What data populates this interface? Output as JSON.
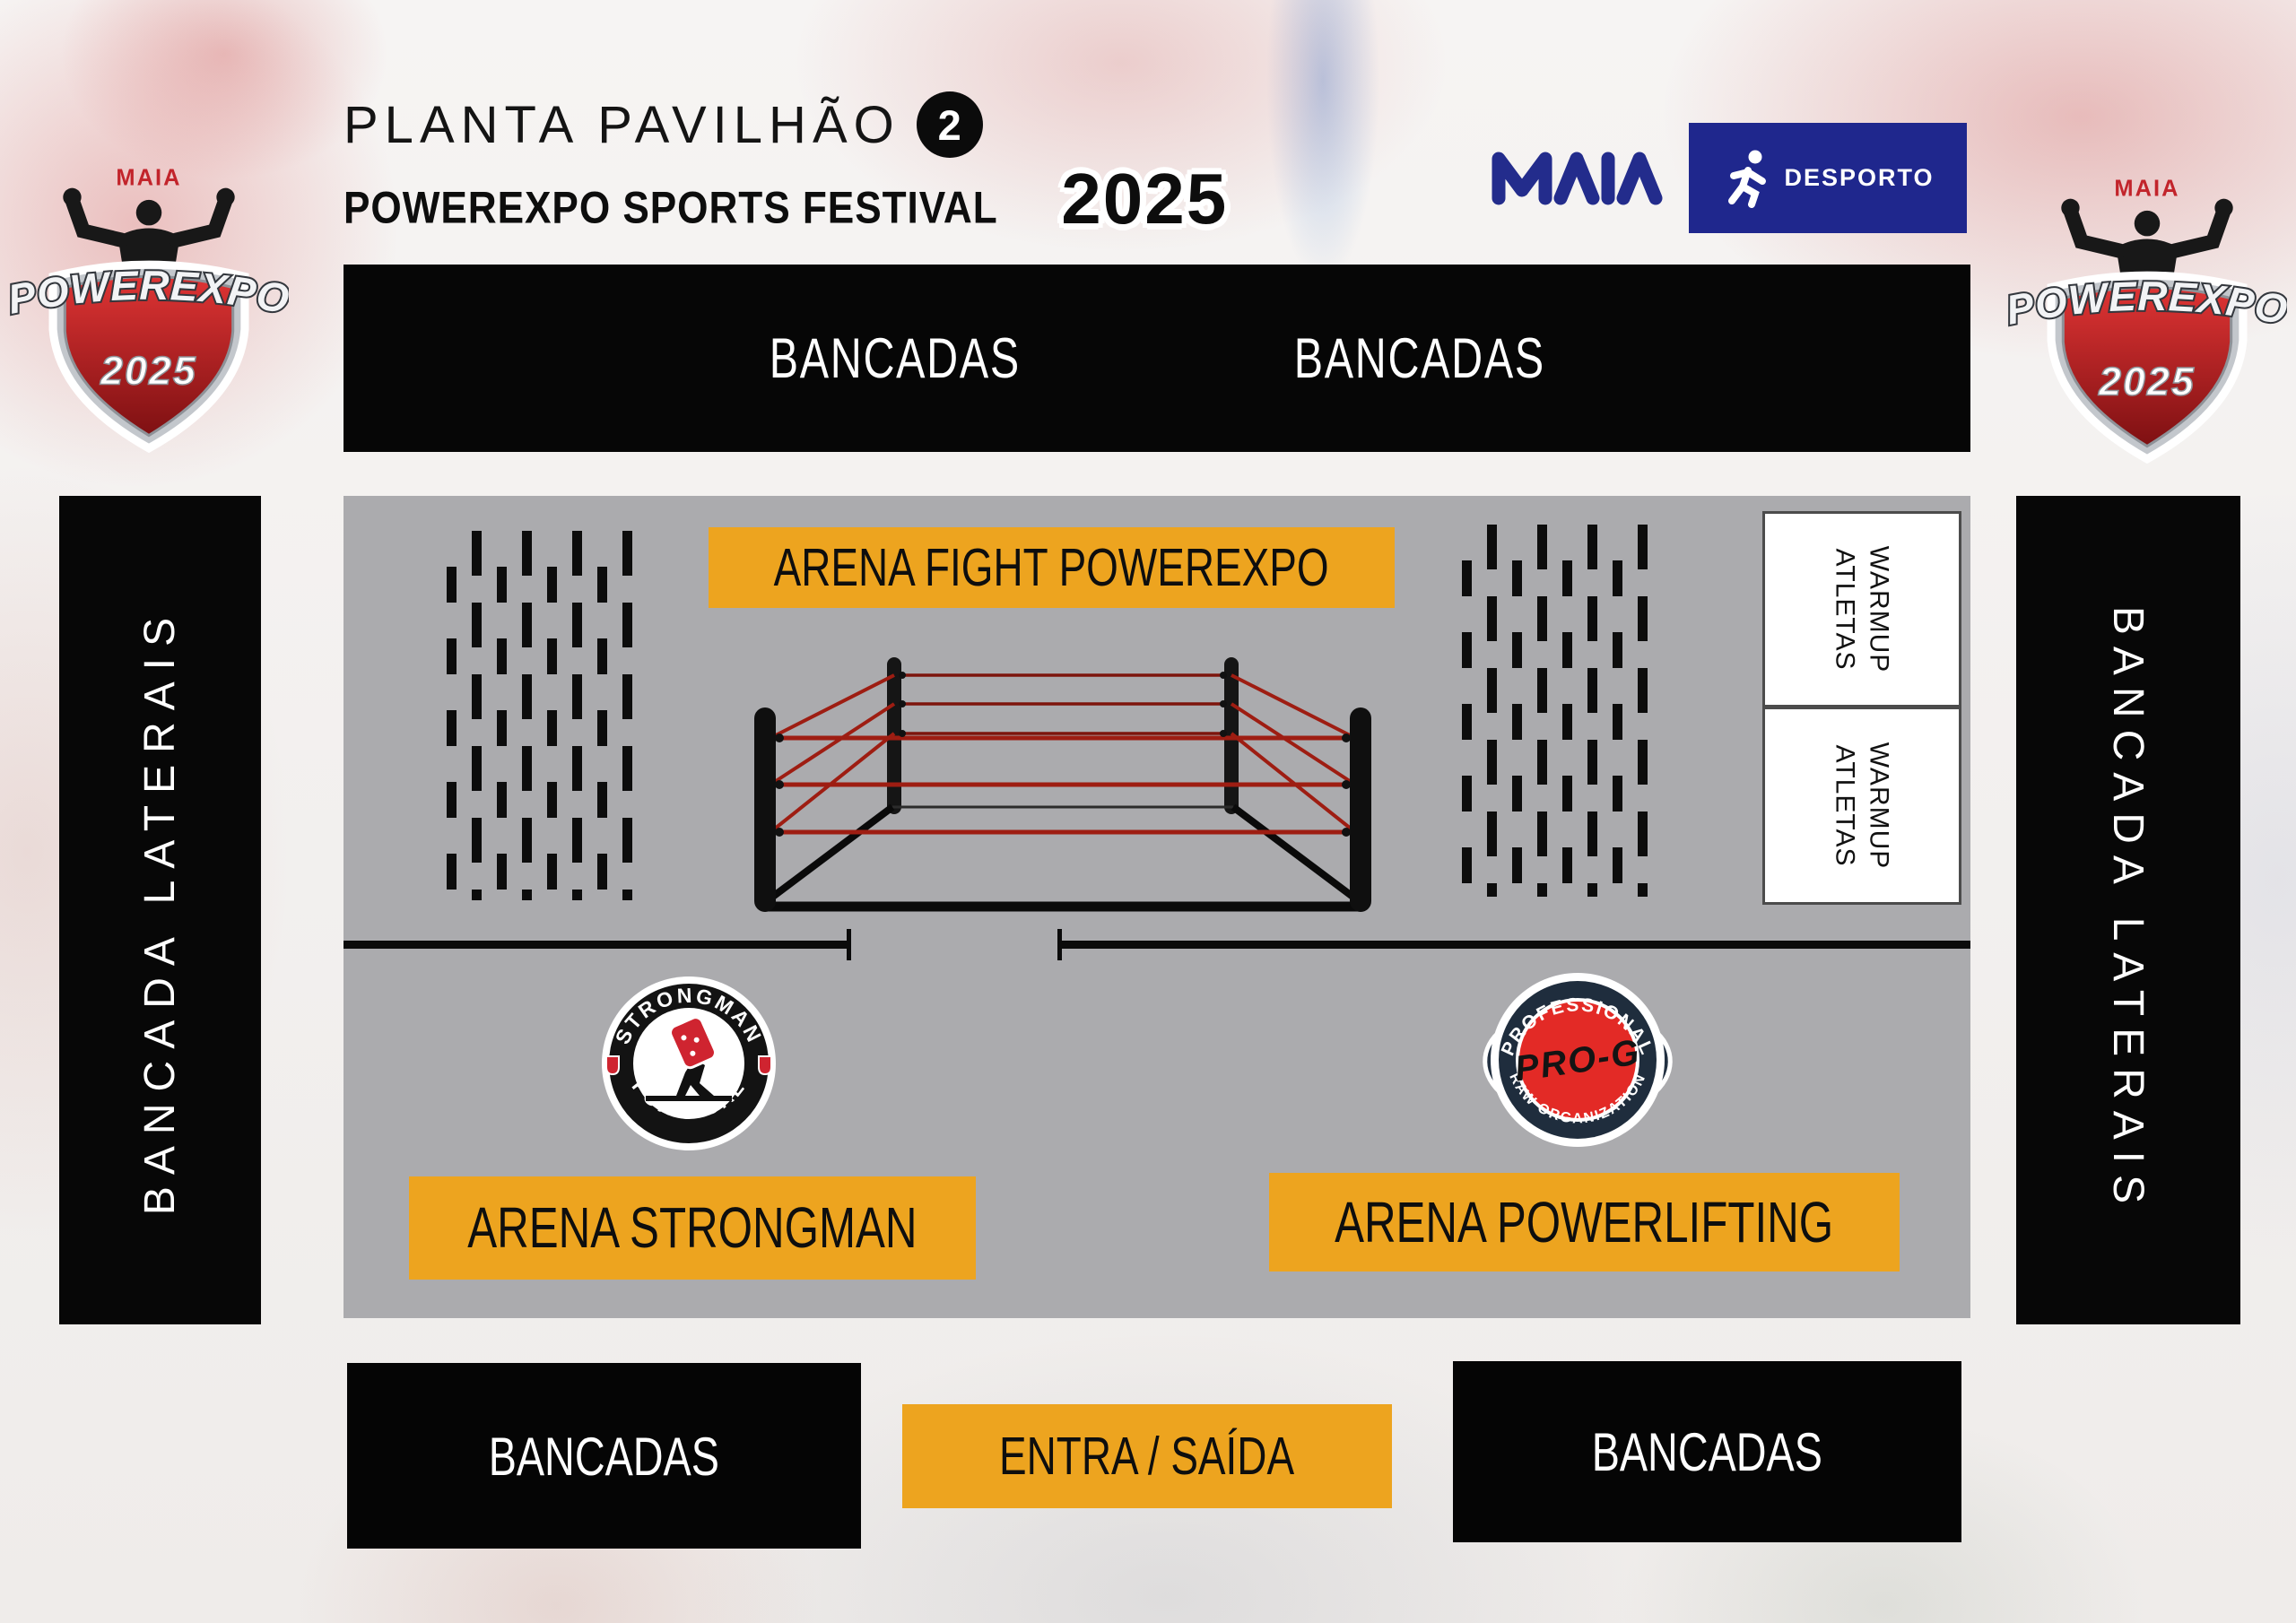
{
  "header": {
    "title_line1": "PLANTA PAVILHÃO",
    "pavilion_number": "2",
    "title_line2": "POWEREXPO SPORTS FESTIVAL",
    "year": "2025"
  },
  "partner_logos": {
    "maia_wordmark": "MAIA",
    "desporto_label": "DESPORTO",
    "desporto_icon": "runner-icon"
  },
  "powerexpo_badge": {
    "brand_top": "MAIA",
    "wordmark": "POWEREXPO",
    "year": "2025"
  },
  "stands": {
    "top": [
      "BANCADAS",
      "BANCADAS"
    ],
    "left_side": "BANCADA LATERAIS",
    "right_side": "BANCADA LATERAIS",
    "bottom_left": "BANCADAS",
    "bottom_right": "BANCADAS"
  },
  "floor": {
    "fight_arena_label": "ARENA FIGHT POWEREXPO",
    "strongman_arena_label": "ARENA STRONGMAN",
    "powerlifting_arena_label": "ARENA POWERLIFTING",
    "warmup_line1": "WARMUP",
    "warmup_line2": "ATLETAS"
  },
  "entrance_label": "ENTRA / SAÍDA",
  "org_badges": {
    "strongman": {
      "arc_top": "STRONGMAN",
      "arc_bottom": "PORTUGAL"
    },
    "prog": {
      "arc_top": "PROFESSIONAL",
      "script": "PRO-G",
      "arc_bottom": "RAW ORGANIZATION"
    }
  },
  "colors": {
    "accent_orange": "#EDA41F",
    "floor_gray": "#ABABAE",
    "stand_black": "#060606",
    "partner_navy": "#1F278D",
    "rope_red": "#9E1D12",
    "badge_red": "#E32A26"
  }
}
